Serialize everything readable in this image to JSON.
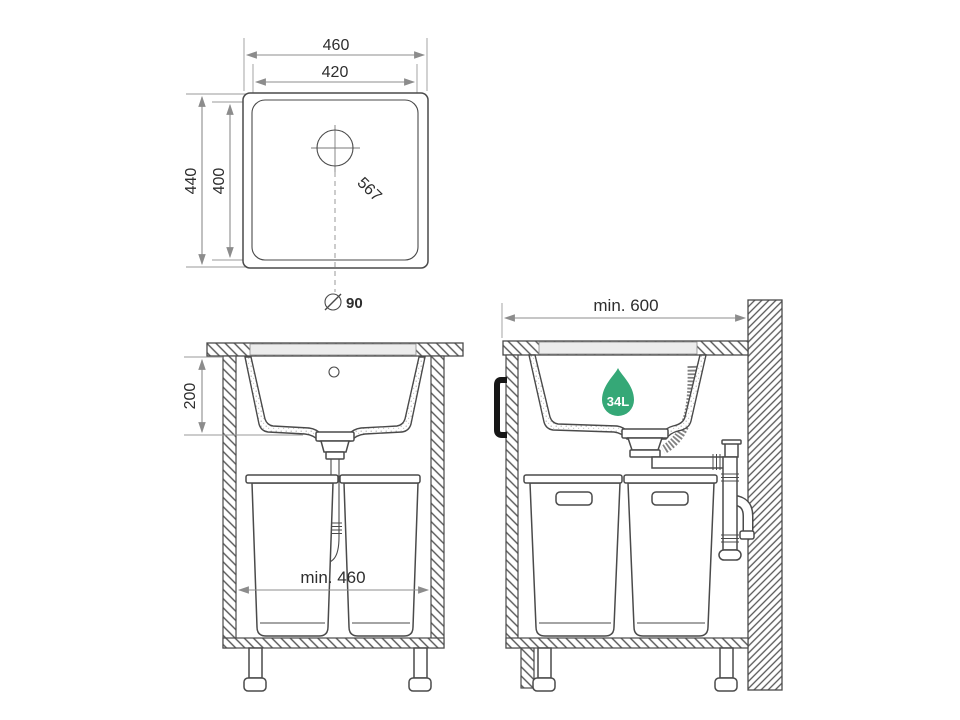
{
  "colors": {
    "accent_green": "#35A877",
    "line": "#4A4A4A",
    "dimension": "#8C8C8C",
    "rim_fill": "#ECECEC",
    "text": "#2E2E2E"
  },
  "top_view": {
    "outer_width": "460",
    "cutout_width": "420",
    "outer_height": "440",
    "cutout_height": "400",
    "diagonal": "567",
    "drain_diameter": "90"
  },
  "front_section_view": {
    "bowl_depth": "200",
    "min_cabinet_width": "min. 460"
  },
  "side_section_view": {
    "min_worktop_width": "min. 600",
    "capacity_badge": "34L"
  }
}
